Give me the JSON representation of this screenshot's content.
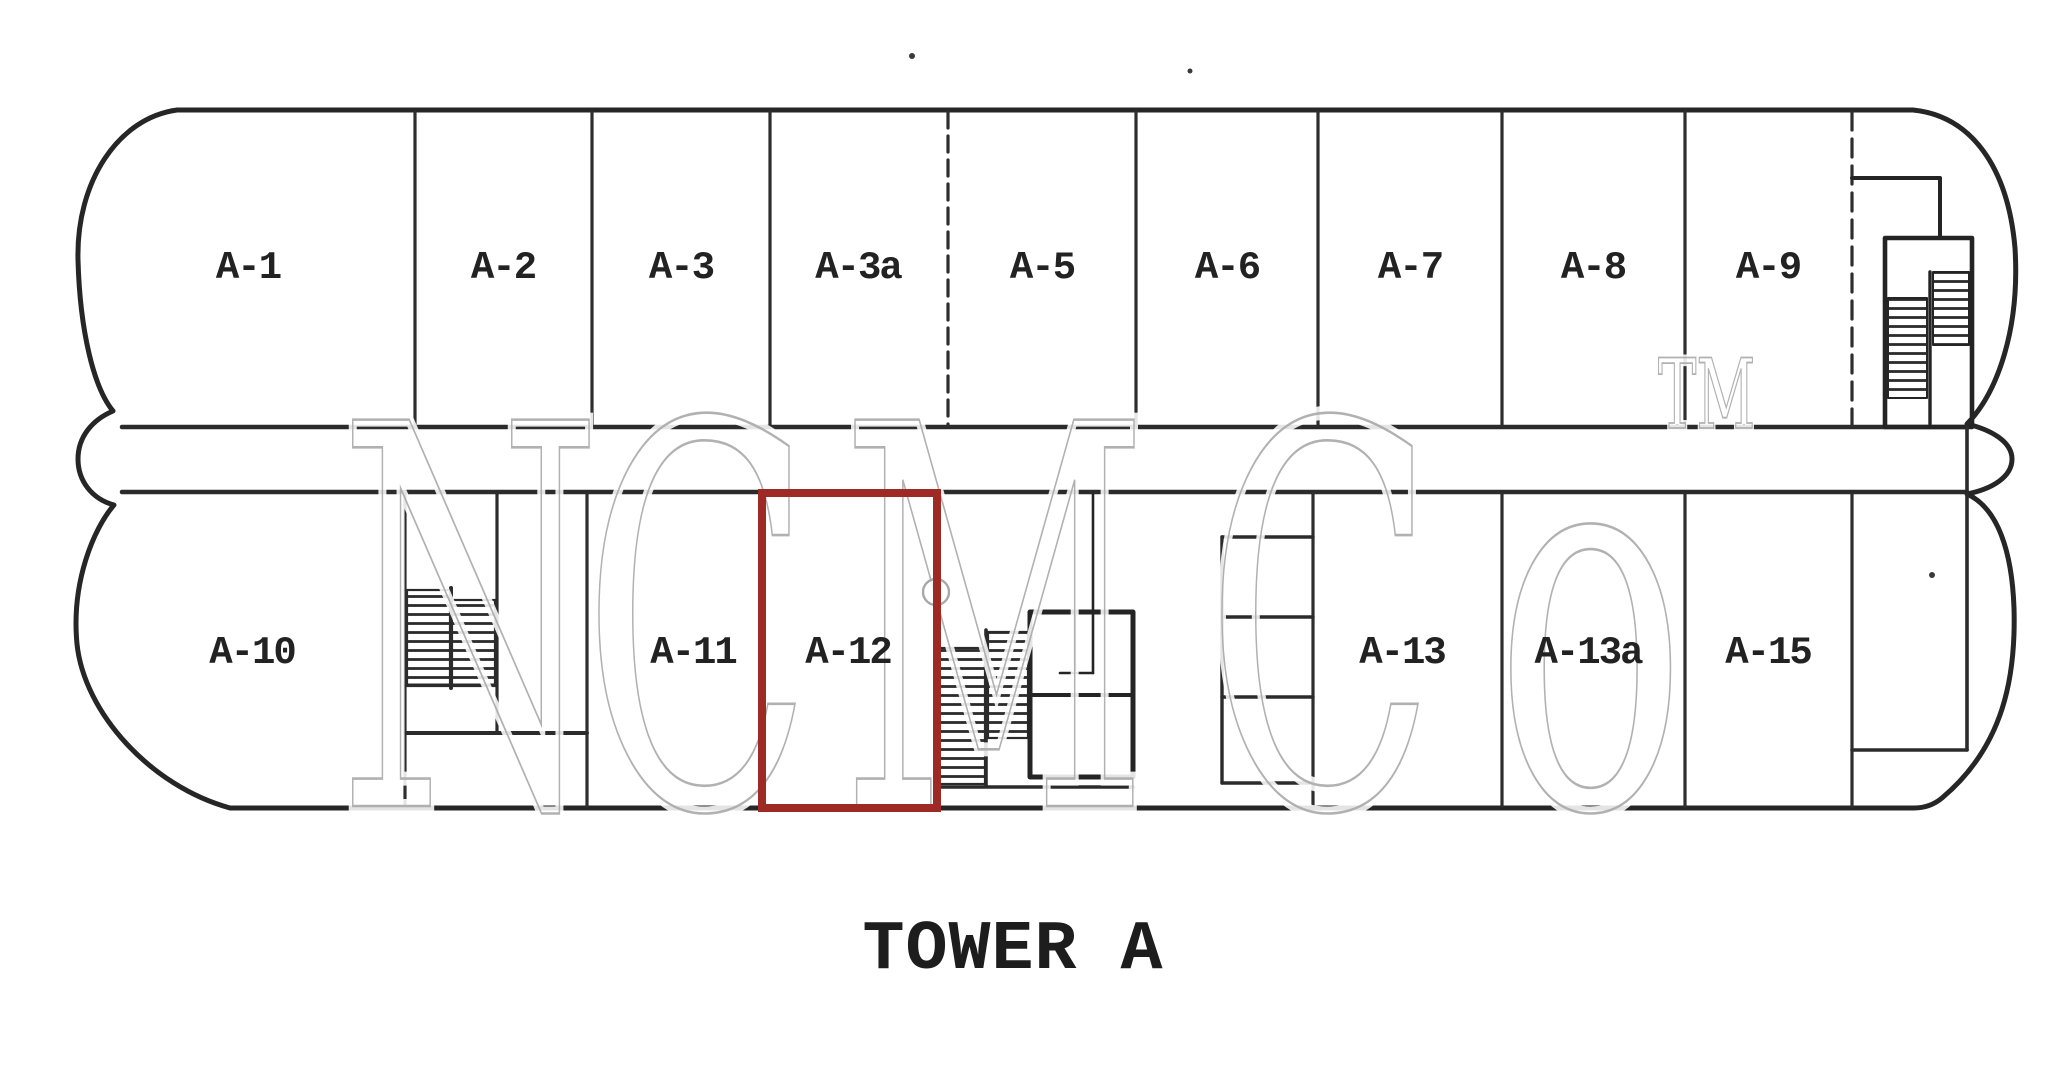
{
  "title": "TOWER A",
  "units": {
    "top": [
      {
        "label": "A-1"
      },
      {
        "label": "A-2"
      },
      {
        "label": "A-3"
      },
      {
        "label": "A-3a"
      },
      {
        "label": "A-5"
      },
      {
        "label": "A-6"
      },
      {
        "label": "A-7"
      },
      {
        "label": "A-8"
      },
      {
        "label": "A-9"
      }
    ],
    "bottom": [
      {
        "label": "A-10"
      },
      {
        "label": "A-11"
      },
      {
        "label": "A-12"
      },
      {
        "label": "A-13"
      },
      {
        "label": "A-13a"
      },
      {
        "label": "A-15"
      }
    ]
  },
  "highlight": {
    "unit": "A-12",
    "color": "#9e2a25"
  },
  "watermark": {
    "letters": [
      "N",
      "C",
      "M",
      "C",
      "o"
    ],
    "trademark": "TM"
  },
  "colors": {
    "ink": "#2b2b2b",
    "watermark_gray": "#a8a8a8",
    "paper": "#ffffff"
  }
}
